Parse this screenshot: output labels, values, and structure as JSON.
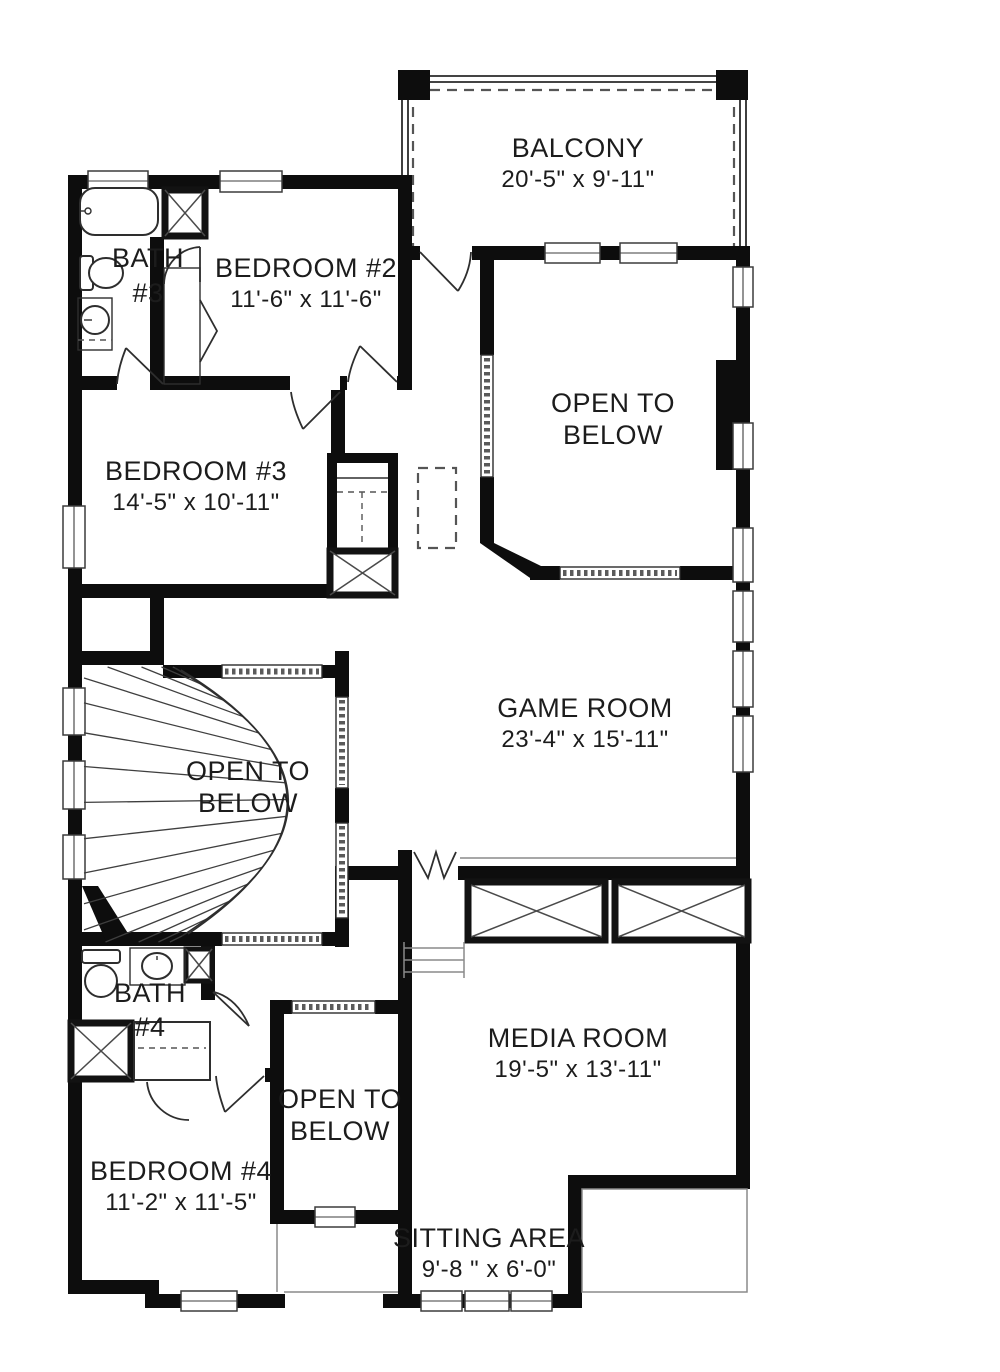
{
  "plan": {
    "type": "residential floor plan"
  },
  "rooms": [
    {
      "id": "balcony",
      "line1": "BALCONY",
      "line2": "20'-5\" x 9'-11\""
    },
    {
      "id": "bath-3",
      "line1": "BATH",
      "line2": "#3"
    },
    {
      "id": "bedroom-2",
      "line1": "BEDROOM #2",
      "line2": "11'-6\" x 11'-6\""
    },
    {
      "id": "open-to-below-upper",
      "line1": "OPEN TO",
      "line2": "BELOW"
    },
    {
      "id": "bedroom-3",
      "line1": "BEDROOM #3",
      "line2": "14'-5\" x 10'-11\""
    },
    {
      "id": "game-room",
      "line1": "GAME ROOM",
      "line2": "23'-4\" x 15'-11\""
    },
    {
      "id": "open-to-below-stair",
      "line1": "OPEN TO",
      "line2": "BELOW"
    },
    {
      "id": "bath-4",
      "line1": "BATH",
      "line2": "#4"
    },
    {
      "id": "media-room",
      "line1": "MEDIA ROOM",
      "line2": "19'-5\" x 13'-11\""
    },
    {
      "id": "open-to-below-lower",
      "line1": "OPEN TO",
      "line2": "BELOW"
    },
    {
      "id": "bedroom-4",
      "line1": "BEDROOM #4",
      "line2": "11'-2\" x 11'-5\""
    },
    {
      "id": "sitting-area",
      "line1": "SITTING AREA",
      "line2": "9'-8 \" x 6'-0\""
    }
  ],
  "fixtures": [
    "bathtub",
    "toilet",
    "sink",
    "shower",
    "linen-closet",
    "bifold-closet",
    "curved-staircase",
    "railing",
    "window",
    "door"
  ],
  "colors": {
    "wall": "#0d0d0d",
    "background": "#ffffff",
    "thin_line": "#8a8a8a",
    "text": "#1c1c1c"
  }
}
